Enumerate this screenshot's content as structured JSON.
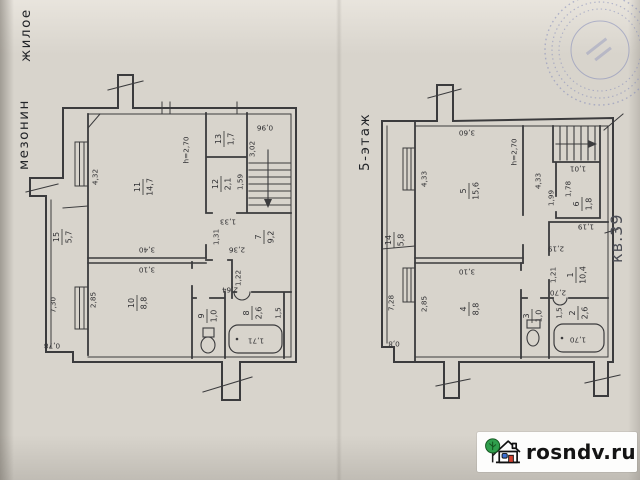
{
  "header": {
    "zhiloe": "жилое",
    "mezonin": "мезонин",
    "floor5": "5-этаж",
    "apartment": "кв.39"
  },
  "left_plan": {
    "rooms": {
      "r11": {
        "num": "11",
        "area": "14,7"
      },
      "r13": {
        "num": "13",
        "area": "1,7"
      },
      "r12": {
        "num": "12",
        "area": "2,1"
      },
      "r7": {
        "num": "7",
        "area": "9,2"
      },
      "r15": {
        "num": "15",
        "area": "5,7"
      },
      "r10": {
        "num": "10",
        "area": "8,8"
      },
      "r9": {
        "num": "9",
        "area": "1,0"
      },
      "r8": {
        "num": "8",
        "area": "2,6"
      }
    },
    "dims": {
      "height": "h=2,70",
      "d432": "4,32",
      "d340": "3,40",
      "d310": "3,10",
      "d285": "2,85",
      "d730": "7,30",
      "d078": "0,78",
      "d096": "0,96",
      "d302": "3,02",
      "d159": "1,59",
      "d133": "1,33",
      "d131": "1,31",
      "d236": "2,36",
      "d122": "1,22",
      "d264": "2,64",
      "d171": "1,71",
      "d15": "1,5"
    }
  },
  "right_plan": {
    "rooms": {
      "r5": {
        "num": "5",
        "area": "15,6"
      },
      "r14": {
        "num": "14",
        "area": "5,8"
      },
      "r4": {
        "num": "4",
        "area": "8,8"
      },
      "r6": {
        "num": "6",
        "area": "1,8"
      },
      "r1": {
        "num": "1",
        "area": "10,4"
      },
      "r3": {
        "num": "3",
        "area": "1,0"
      },
      "r2": {
        "num": "2",
        "area": "2,6"
      }
    },
    "dims": {
      "height": "h=2,70",
      "d360": "3,60",
      "d433a": "4,33",
      "d433b": "4,33",
      "d101": "1,01",
      "d178": "1,78",
      "d199": "1,99",
      "d119": "1,19",
      "d219": "2,19",
      "d728": "7,28",
      "d08": "0,8",
      "d310": "3,10",
      "d285": "2,85",
      "d121": "1,21",
      "d270": "2,70",
      "d170": "1,70",
      "d15": "1,5"
    }
  },
  "watermark": {
    "site": "rosndv.ru"
  },
  "colors": {
    "paper": "#d8d4cc",
    "line": "#3b3b3d",
    "stamp": "#7b84b8",
    "logo_tree": "#2f9e4c",
    "logo_door": "#d2402f",
    "logo_window": "#3b6fd4"
  }
}
